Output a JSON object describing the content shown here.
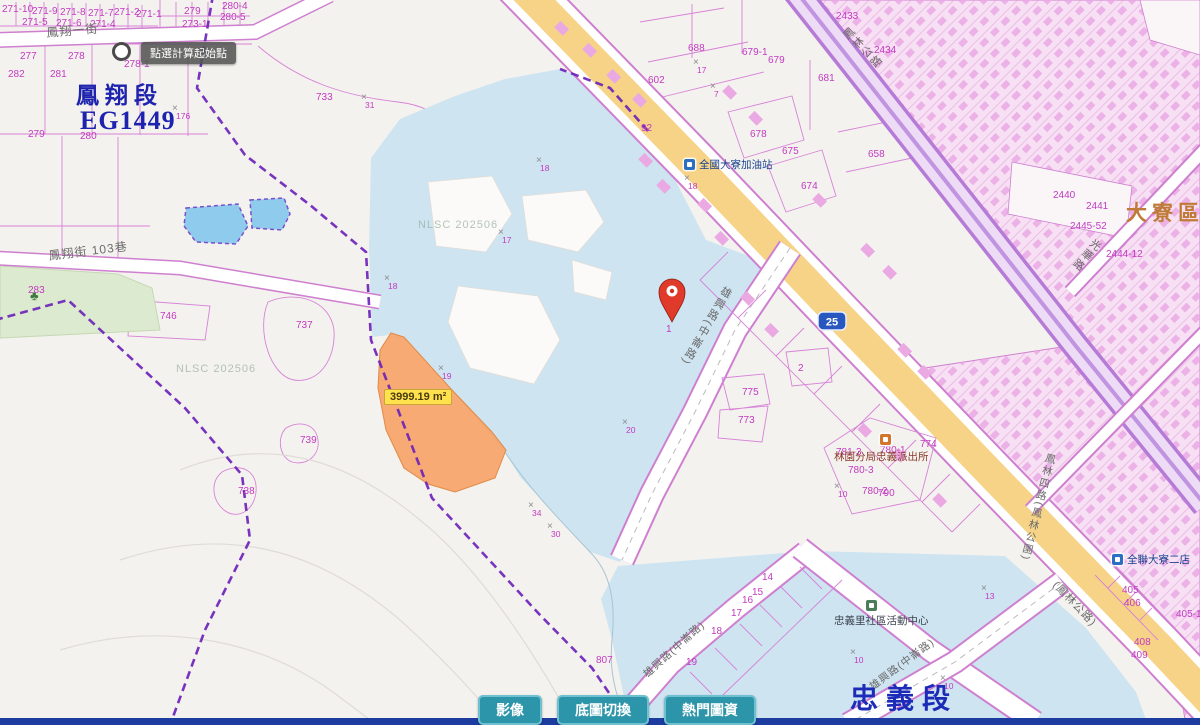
{
  "map": {
    "watermark": "NLSC 202506",
    "mark_glyph": "×",
    "watermarks": [
      {
        "x": 418,
        "y": 219
      },
      {
        "x": 176,
        "y": 363
      }
    ],
    "region_labels": [
      {
        "text": "鳳翔段",
        "x": 76,
        "y": 84,
        "size": 23,
        "color": "#1d23ae",
        "spacing": 6
      },
      {
        "text": "EG1449",
        "x": 80,
        "y": 108,
        "size": 26,
        "color": "#1d23ae",
        "spacing": 1
      },
      {
        "text": "忠義段",
        "x": 850,
        "y": 686,
        "size": 28,
        "color": "#1d2cb8",
        "spacing": 8
      },
      {
        "text": "大寮區",
        "x": 1126,
        "y": 203,
        "size": 21,
        "color": "#bf7b35",
        "spacing": 5
      }
    ],
    "tooltip": {
      "text": "點選計算起始點"
    },
    "selected_parcel": {
      "area_label": "3999.19 m²"
    },
    "route_shield": {
      "number": "25"
    },
    "street_labels": [
      {
        "text": "鳳翔一街",
        "x": 46,
        "y": 27,
        "rot": -5,
        "vertical": false,
        "size": 12
      },
      {
        "text": "鳳翔街 103巷",
        "x": 48,
        "y": 250,
        "rot": -7,
        "vertical": false,
        "size": 12
      },
      {
        "text": "(鳳林公路)",
        "x": 1058,
        "y": 580,
        "rot": 46,
        "vertical": false,
        "size": 11
      },
      {
        "text": "鳳林公路",
        "x": 840,
        "y": 34,
        "rot": -44,
        "vertical": true,
        "size": 11
      },
      {
        "text": "雄興路(中崙路)",
        "x": 723,
        "y": 284,
        "rot": 30,
        "vertical": true,
        "size": 11
      },
      {
        "text": "雄興路(中崙路)",
        "x": 642,
        "y": 672,
        "rot": -42,
        "vertical": false,
        "size": 10.5
      },
      {
        "text": "雄興路(中崙路)",
        "x": 868,
        "y": 684,
        "rot": -37,
        "vertical": false,
        "size": 10.5
      },
      {
        "text": "鳳林四路(鳳林公園)",
        "x": 1046,
        "y": 452,
        "rot": 14,
        "vertical": true,
        "size": 10.5
      },
      {
        "text": "光華路",
        "x": 1094,
        "y": 236,
        "rot": 40,
        "vertical": true,
        "size": 11
      }
    ],
    "pois": [
      {
        "name": "全國大寮加油站",
        "icon": "gas-station-icon",
        "ix": 684,
        "iy": 159,
        "x": 699,
        "y": 160,
        "color": "#16418e",
        "iconColor": "#2a6fc0"
      },
      {
        "name": "林園分局忠義派出所",
        "icon": "police-station-icon",
        "ix": 880,
        "iy": 434,
        "x": 834,
        "y": 452,
        "color": "#8a3a2a",
        "iconColor": "#d1762a"
      },
      {
        "name": "忠義里社區活動中心",
        "icon": "community-center-icon",
        "ix": 866,
        "iy": 600,
        "x": 834,
        "y": 616,
        "color": "#3c4450",
        "iconColor": "#4a7d5a"
      },
      {
        "name": "全聯大寮二店",
        "icon": "supermarket-icon",
        "ix": 1112,
        "iy": 554,
        "x": 1127,
        "y": 555,
        "color": "#16418e",
        "iconColor": "#2a6fc0"
      }
    ],
    "parcel_numbers": [
      {
        "x": 2,
        "y": 5,
        "t": "271-10"
      },
      {
        "x": 32,
        "y": 7,
        "t": "271-9"
      },
      {
        "x": 60,
        "y": 8,
        "t": "271-8"
      },
      {
        "x": 88,
        "y": 9,
        "t": "271-7"
      },
      {
        "x": 114,
        "y": 8,
        "t": "271-2"
      },
      {
        "x": 136,
        "y": 10,
        "t": "271-1"
      },
      {
        "x": 22,
        "y": 18,
        "t": "271-5"
      },
      {
        "x": 56,
        "y": 19,
        "t": "271-6"
      },
      {
        "x": 90,
        "y": 20,
        "t": "271-4"
      },
      {
        "x": 182,
        "y": 20,
        "t": "273-1"
      },
      {
        "x": 184,
        "y": 7,
        "t": "279"
      },
      {
        "x": 222,
        "y": 2,
        "t": "280-4"
      },
      {
        "x": 220,
        "y": 13,
        "t": "280-5"
      },
      {
        "x": 20,
        "y": 52,
        "t": "277"
      },
      {
        "x": 68,
        "y": 52,
        "t": "278"
      },
      {
        "x": 124,
        "y": 60,
        "t": "278-1"
      },
      {
        "x": 8,
        "y": 70,
        "t": "282"
      },
      {
        "x": 50,
        "y": 70,
        "t": "281"
      },
      {
        "x": 28,
        "y": 130,
        "t": "279"
      },
      {
        "x": 80,
        "y": 132,
        "t": "280"
      },
      {
        "x": 28,
        "y": 286,
        "t": "283"
      },
      {
        "x": 160,
        "y": 312,
        "t": "746"
      },
      {
        "x": 316,
        "y": 93,
        "t": "733"
      },
      {
        "x": 296,
        "y": 321,
        "t": "737"
      },
      {
        "x": 300,
        "y": 436,
        "t": "739"
      },
      {
        "x": 238,
        "y": 487,
        "t": "738"
      },
      {
        "x": 596,
        "y": 656,
        "t": "807"
      },
      {
        "x": 738,
        "y": 416,
        "t": "773"
      },
      {
        "x": 742,
        "y": 388,
        "t": "775"
      },
      {
        "x": 798,
        "y": 364,
        "t": "2"
      },
      {
        "x": 666,
        "y": 325,
        "t": "1"
      },
      {
        "x": 762,
        "y": 573,
        "t": "14"
      },
      {
        "x": 752,
        "y": 588,
        "t": "15"
      },
      {
        "x": 742,
        "y": 596,
        "t": "16"
      },
      {
        "x": 731,
        "y": 609,
        "t": "17"
      },
      {
        "x": 711,
        "y": 627,
        "t": "18"
      },
      {
        "x": 686,
        "y": 658,
        "t": "19"
      },
      {
        "x": 836,
        "y": 448,
        "t": "781-3"
      },
      {
        "x": 880,
        "y": 446,
        "t": "780-1"
      },
      {
        "x": 848,
        "y": 466,
        "t": "780-3"
      },
      {
        "x": 862,
        "y": 487,
        "t": "780-2"
      },
      {
        "x": 878,
        "y": 489,
        "t": "790"
      },
      {
        "x": 920,
        "y": 440,
        "t": "774"
      },
      {
        "x": 688,
        "y": 44,
        "t": "688"
      },
      {
        "x": 742,
        "y": 48,
        "t": "679-1"
      },
      {
        "x": 768,
        "y": 56,
        "t": "679"
      },
      {
        "x": 818,
        "y": 74,
        "t": "681"
      },
      {
        "x": 648,
        "y": 76,
        "t": "602"
      },
      {
        "x": 641,
        "y": 124,
        "t": "92"
      },
      {
        "x": 750,
        "y": 130,
        "t": "678"
      },
      {
        "x": 782,
        "y": 147,
        "t": "675"
      },
      {
        "x": 868,
        "y": 150,
        "t": "658"
      },
      {
        "x": 801,
        "y": 182,
        "t": "674"
      },
      {
        "x": 836,
        "y": 12,
        "t": "2433"
      },
      {
        "x": 874,
        "y": 46,
        "t": "2434"
      },
      {
        "x": 1053,
        "y": 191,
        "t": "2440"
      },
      {
        "x": 1086,
        "y": 202,
        "t": "2441"
      },
      {
        "x": 1070,
        "y": 222,
        "t": "2445-52"
      },
      {
        "x": 1106,
        "y": 250,
        "t": "2444-12"
      },
      {
        "x": 1122,
        "y": 586,
        "t": "405"
      },
      {
        "x": 1124,
        "y": 599,
        "t": "406"
      },
      {
        "x": 1176,
        "y": 610,
        "t": "405-1"
      },
      {
        "x": 1134,
        "y": 638,
        "t": "408"
      },
      {
        "x": 1131,
        "y": 651,
        "t": "409"
      }
    ],
    "survey_marks": [
      {
        "x": 536,
        "y": 156,
        "n": "18"
      },
      {
        "x": 498,
        "y": 228,
        "n": "17"
      },
      {
        "x": 384,
        "y": 274,
        "n": "18"
      },
      {
        "x": 438,
        "y": 364,
        "n": "19"
      },
      {
        "x": 622,
        "y": 418,
        "n": "20"
      },
      {
        "x": 528,
        "y": 501,
        "n": "34"
      },
      {
        "x": 547,
        "y": 522,
        "n": "30"
      },
      {
        "x": 684,
        "y": 174,
        "n": "18"
      },
      {
        "x": 834,
        "y": 482,
        "n": "10"
      },
      {
        "x": 850,
        "y": 648,
        "n": "10"
      },
      {
        "x": 940,
        "y": 674,
        "n": "10"
      },
      {
        "x": 981,
        "y": 584,
        "n": "13"
      },
      {
        "x": 710,
        "y": 82,
        "n": "7"
      },
      {
        "x": 693,
        "y": 58,
        "n": "17"
      },
      {
        "x": 172,
        "y": 104,
        "n": "176"
      },
      {
        "x": 361,
        "y": 93,
        "n": "31"
      }
    ]
  },
  "toolbar": {
    "buttons": [
      {
        "name": "imagery-button",
        "label": "影像"
      },
      {
        "name": "basemap-toggle-button",
        "label": "底圖切換"
      },
      {
        "name": "popular-layers-button",
        "label": "熱門圖資"
      }
    ]
  },
  "colors": {
    "water": "#cee4f1",
    "highway_yellow": "#f6d387",
    "parcel_line": "#d783d7",
    "dense_fill": "#f7e0f4",
    "building_pink": "#eaa9e3",
    "selection_orange": "#f6a469",
    "boundary_purple": "#6a1fb8",
    "button_teal": "#2d95a9",
    "bottom_bar": "#1d3ca0",
    "park_green": "#dcead0",
    "pond_blue": "#8fcbec",
    "label_magenta": "#c23ac2",
    "pin_red": "#e03a2a",
    "shield_blue": "#2857c0"
  }
}
